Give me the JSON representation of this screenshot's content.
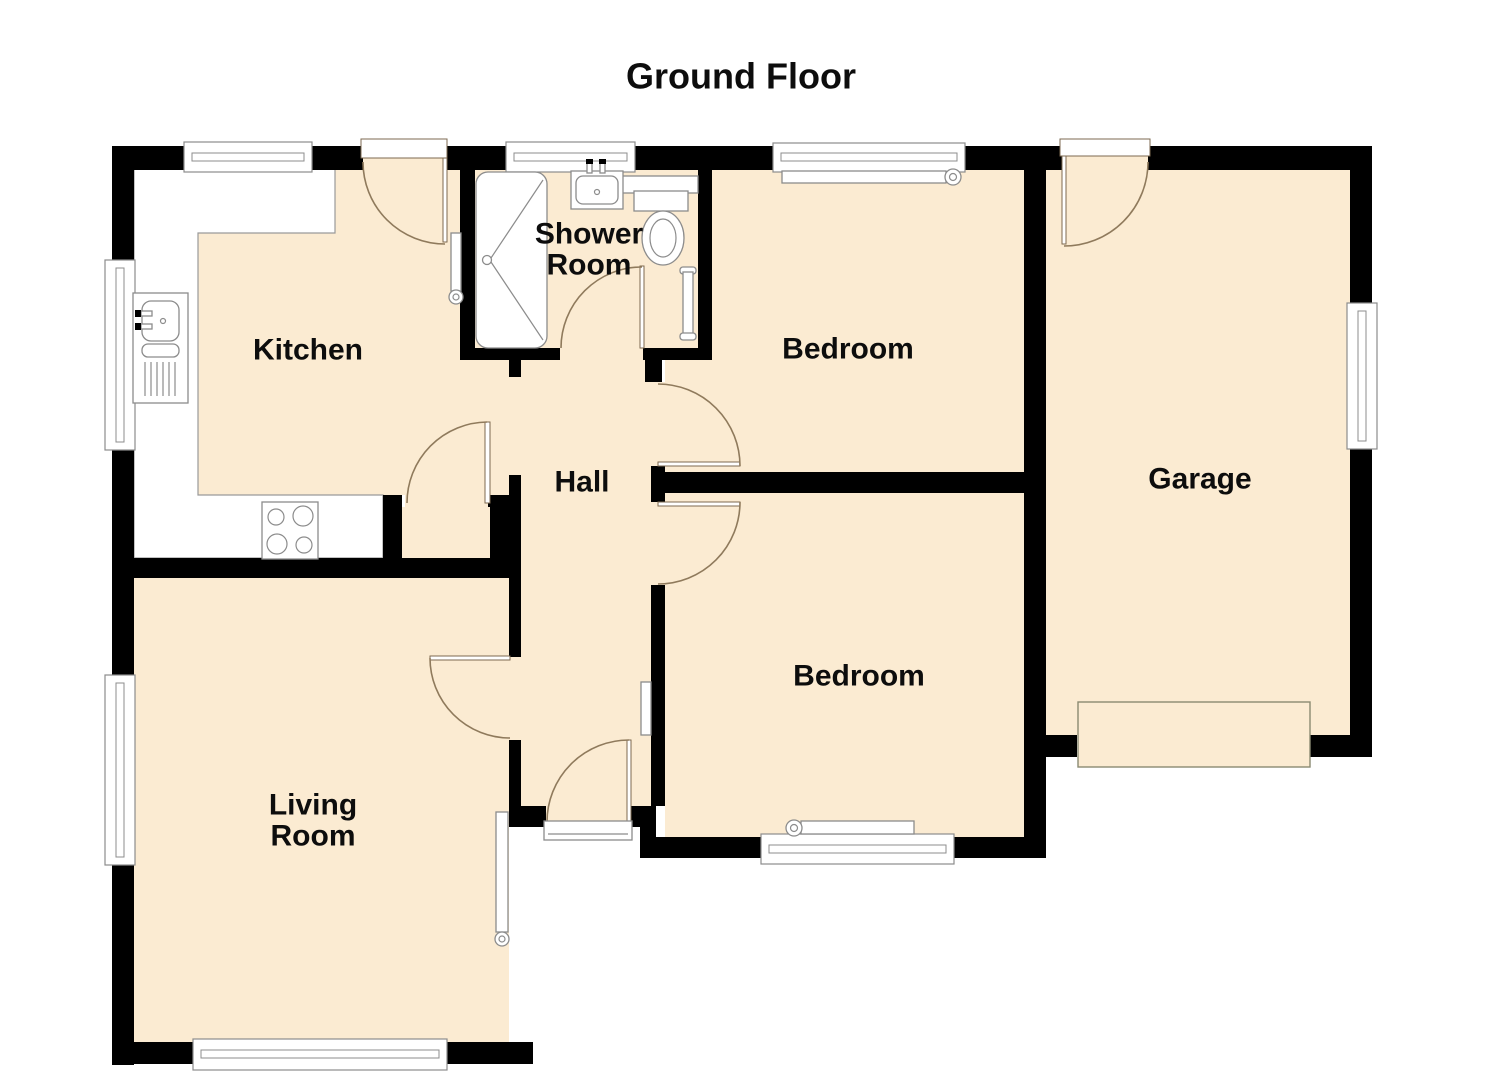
{
  "title": "Ground Floor",
  "rooms": {
    "kitchen": {
      "label": "Kitchen"
    },
    "shower_room": {
      "label": "Shower\nRoom"
    },
    "bedroom_top": {
      "label": "Bedroom"
    },
    "garage": {
      "label": "Garage"
    },
    "hall": {
      "label": "Hall"
    },
    "bedroom_bottom": {
      "label": "Bedroom"
    },
    "living_room": {
      "label": "Living\nRoom"
    }
  },
  "fixtures": {
    "icons": [
      "kitchen-sink-icon",
      "hob-icon",
      "shower-tray-icon",
      "washbasin-icon",
      "toilet-icon",
      "radiator-icon",
      "window-icon",
      "door-swing-icon",
      "garage-door-icon",
      "front-door-threshold-icon"
    ]
  },
  "colors": {
    "wall": "#000000",
    "floor_fill": "#FBEBD2",
    "fixture_stroke": "#8c8c8c",
    "door_arc": "#8f7a5c",
    "background": "#ffffff",
    "label_text": "#0d0d0d"
  }
}
